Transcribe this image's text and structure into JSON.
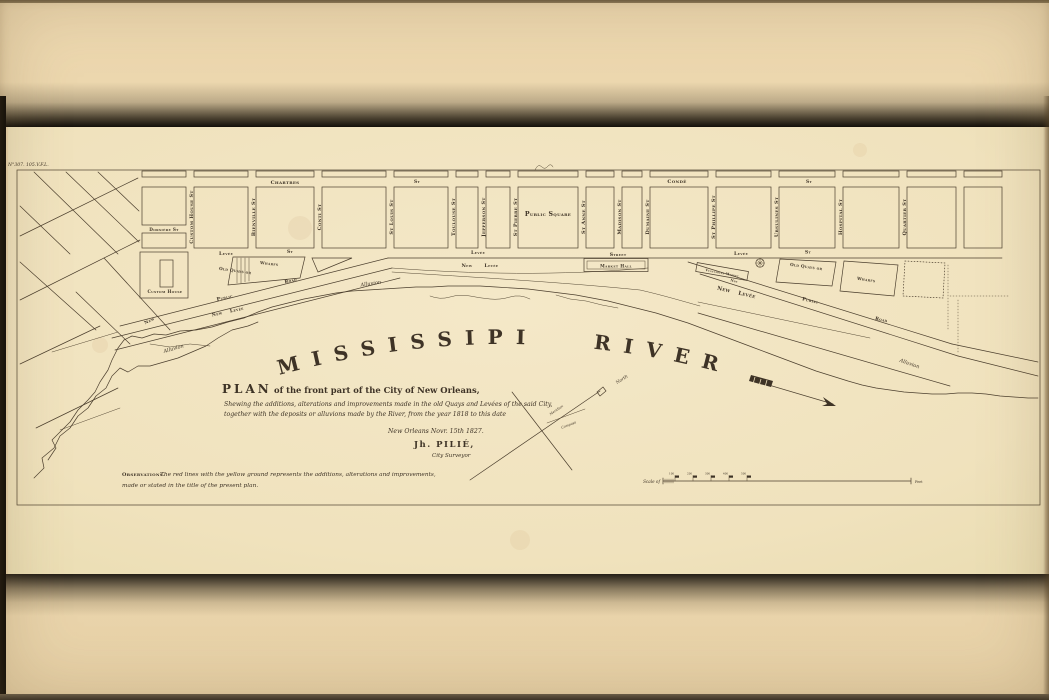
{
  "poster": {
    "plate_ref": "N°307. 105.V.F.L."
  },
  "title_block": {
    "title_word": "PLAN",
    "title_rest": "of the front part of the City of New Orleans,",
    "subtitle1": "Shewing the additions, alterations and improvements made in the old Quays and Levées of the said City,",
    "subtitle2": "together with the deposits or alluvions made by the River, from the year 1818 to this date",
    "dateline": "New Orleans Novr. 15th 1827.",
    "author": "Jh. PILIÉ,",
    "author_role": "City Surveyor"
  },
  "observations": {
    "label": "Observations.",
    "line1": "The red lines with the yellow ground represents the additions, alterations and improvements,",
    "line2": "made or stated in the title of the present plan."
  },
  "river": {
    "word1": "MISSISSIPI",
    "word2": "RIVER"
  },
  "compass": {
    "north": "North",
    "meridian": "Meridian",
    "needle": "Compass"
  },
  "scale": {
    "label": "Scale of",
    "ticks": [
      "100",
      "200",
      "300",
      "400",
      "500"
    ],
    "unit": "Feet"
  },
  "streets": {
    "chartres": "Chartres",
    "conde": "Condé",
    "st": "St",
    "dorsiere": "Dorsière St",
    "custom_house": "Custom House St",
    "bienville": "Bienville St",
    "conti": "Conti St",
    "st_louis": "St Louis St",
    "toulouse": "Toulouse St",
    "jefferson": "Jefferson St",
    "st_pierre": "St Pierre St",
    "st_anne": "St Anne St",
    "madison": "Madison St",
    "dumaine": "Dumaine St",
    "st_phillipe": "St Phillipe St",
    "ursulines": "Ursulines St",
    "hospital": "Hospital St",
    "quartier": "Quartier St",
    "levee": "Levée",
    "street": "Street",
    "new_levee": "New Levée",
    "new": "New",
    "public": "Public",
    "road": "Road",
    "alluvion": "Alluvion",
    "old_quays_or": "Old Quays or",
    "wharfs": "Wharfs"
  },
  "places": {
    "public_square": "Public Square",
    "custom_house": "Custom House",
    "market_hall": "Market Hall",
    "vegetables_market": "Vegetables Market"
  },
  "colors": {
    "paper": "#f0e2bf",
    "poster": "#ecd7ae",
    "ink": "#4a3e2e"
  }
}
